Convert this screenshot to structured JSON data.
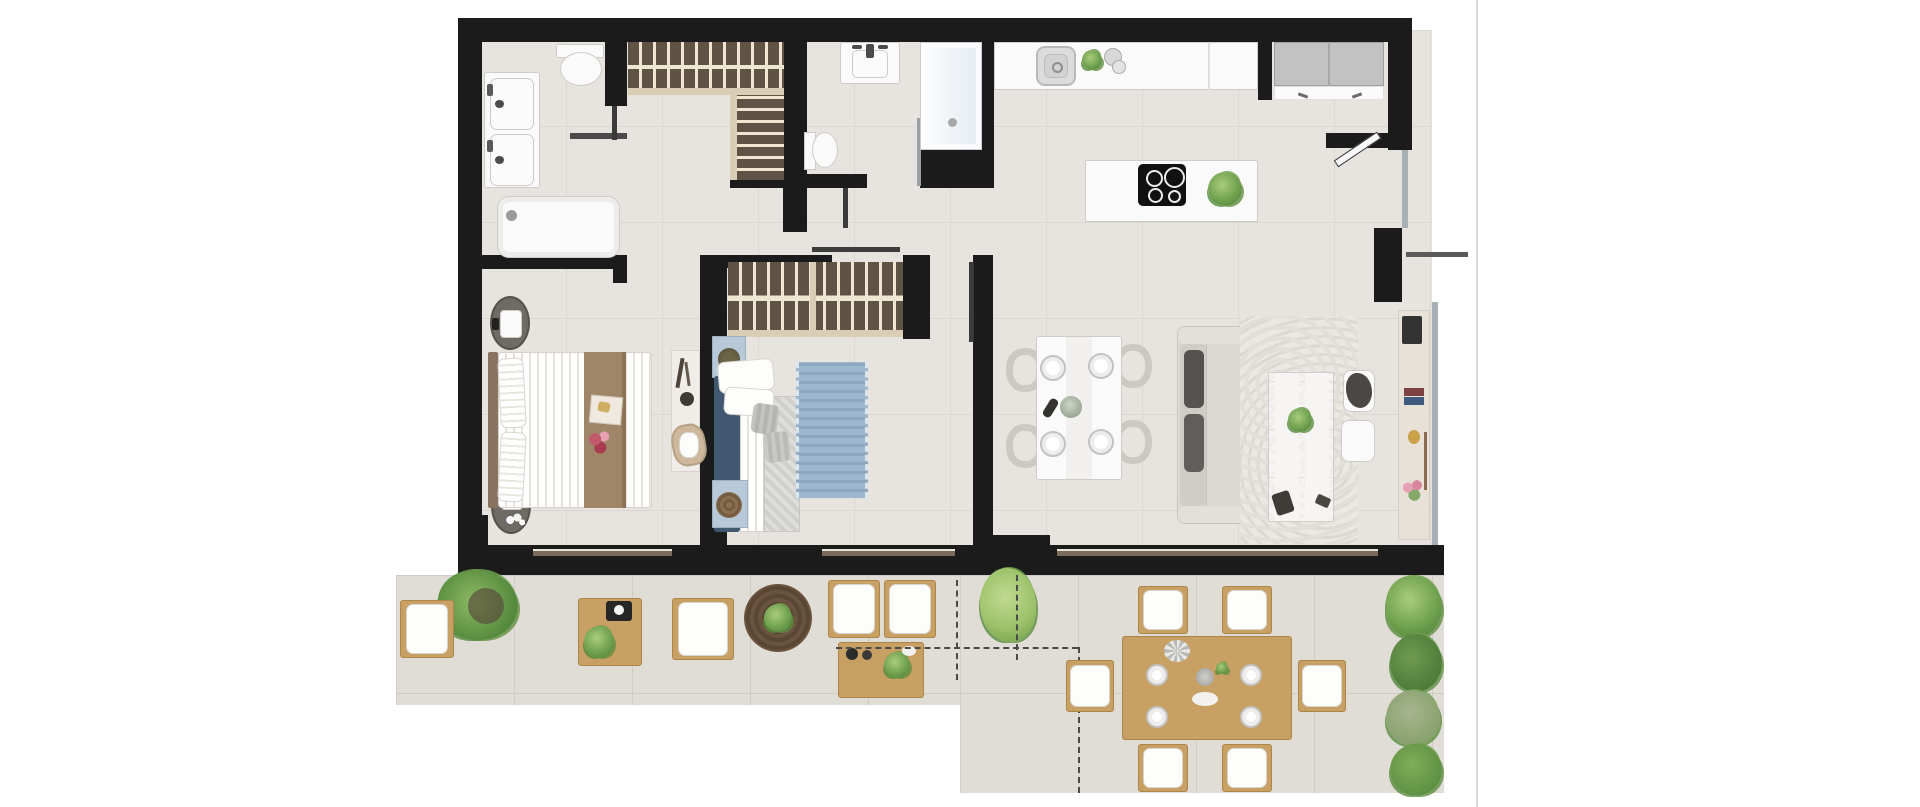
{
  "canvas": {
    "width": 1920,
    "height": 807,
    "background": "#ffffff"
  },
  "page_divider": {
    "x": 1476,
    "color": "#dadada"
  },
  "colors": {
    "wall": "#1b1b1b",
    "floor": "#e7e4df",
    "floorLine": "#dcd7d0",
    "terrace": "#e0dcd6",
    "terraceLine": "#d0cbc3",
    "wood": "#5f5346",
    "woodBar": "#efe6d2",
    "woodTrim": "#d9cdb5",
    "furnWhite": "#fbfafa",
    "furnLine": "#cfccc7",
    "sofa": "#dcd9d4",
    "darkPillow": "#55524f",
    "navy": "#405870",
    "softBlue": "#9db7cf",
    "paleBlue": "#b7c9d8",
    "bedBrown": "#a08668",
    "terWood": "#c9a063",
    "terWoodEdge": "#ac8548",
    "green": "#6fa14e",
    "greenDark": "#4e7d3a",
    "greenPale": "#9cc26a",
    "windowBrown": "#7b695a",
    "glass": "#a7b0b5",
    "dash": "#4a4a4a",
    "pink": "#e8a0b4",
    "hob": "#111111",
    "cabinetGray": "#c2c2c2"
  },
  "floorplan": {
    "kind": "residential apartment floor plan, top-down 2D render, unlabeled",
    "rooms": [
      "master-bathroom",
      "walk-in-closet",
      "second-bathroom",
      "hallway",
      "kitchen",
      "entry-hall",
      "master-bedroom",
      "bedroom-2",
      "living-dining-room",
      "terrace"
    ],
    "fixtures": {
      "master_bathroom": [
        "double-sink-vanity",
        "toilet",
        "bathtub",
        "partition-wall"
      ],
      "walk_in_closet": [
        "hanging-rail-wardrobe",
        "shelf-wardrobe"
      ],
      "second_bathroom": [
        "sink-vanity",
        "toilet",
        "walk-in-shower",
        "glass-panel"
      ],
      "kitchen": [
        "counter-with-sink",
        "herb-plant",
        "jars",
        "island",
        "induction-hob",
        "lettuce-plant"
      ],
      "entry_hall": [
        "utility-cabinets",
        "entry-door-leaf"
      ],
      "master_bedroom": [
        "double-bed",
        "round-nightstand-with-lamp",
        "round-nightstand-with-flowers",
        "desk",
        "desk-chair",
        "decor-tray",
        "flower-bouquet"
      ],
      "bedroom_2": [
        "wardrobe",
        "bed",
        "blue-fringed-rug",
        "blue-nightstand",
        "blue-bench-with-pouf"
      ],
      "living_dining": [
        "dining-table",
        "wine-bottle",
        "centerpiece-plant",
        "sofa",
        "fur-rug",
        "glass-coffee-table",
        "pouf-with-blanket",
        "pouf",
        "tv-wall",
        "console-shelf",
        "flower-pot"
      ]
    },
    "counts": {
      "dining_chairs": 4,
      "dining_plates": 4,
      "outdoor_chairs": 6,
      "outdoor_lounge_seats": 4,
      "terrace_plants": 7
    },
    "terrace_items": [
      "fern-pot",
      "lounge-chair",
      "wood-coffee-table",
      "tray",
      "round-wicker-rug",
      "armchair-pair",
      "outdoor-dining-table",
      "planter-row",
      "boundary-dashed-lines"
    ],
    "windows": [
      "master-bedroom-window",
      "bedroom2-window",
      "living-room-window",
      "side-window-upper",
      "side-window-lower"
    ]
  }
}
